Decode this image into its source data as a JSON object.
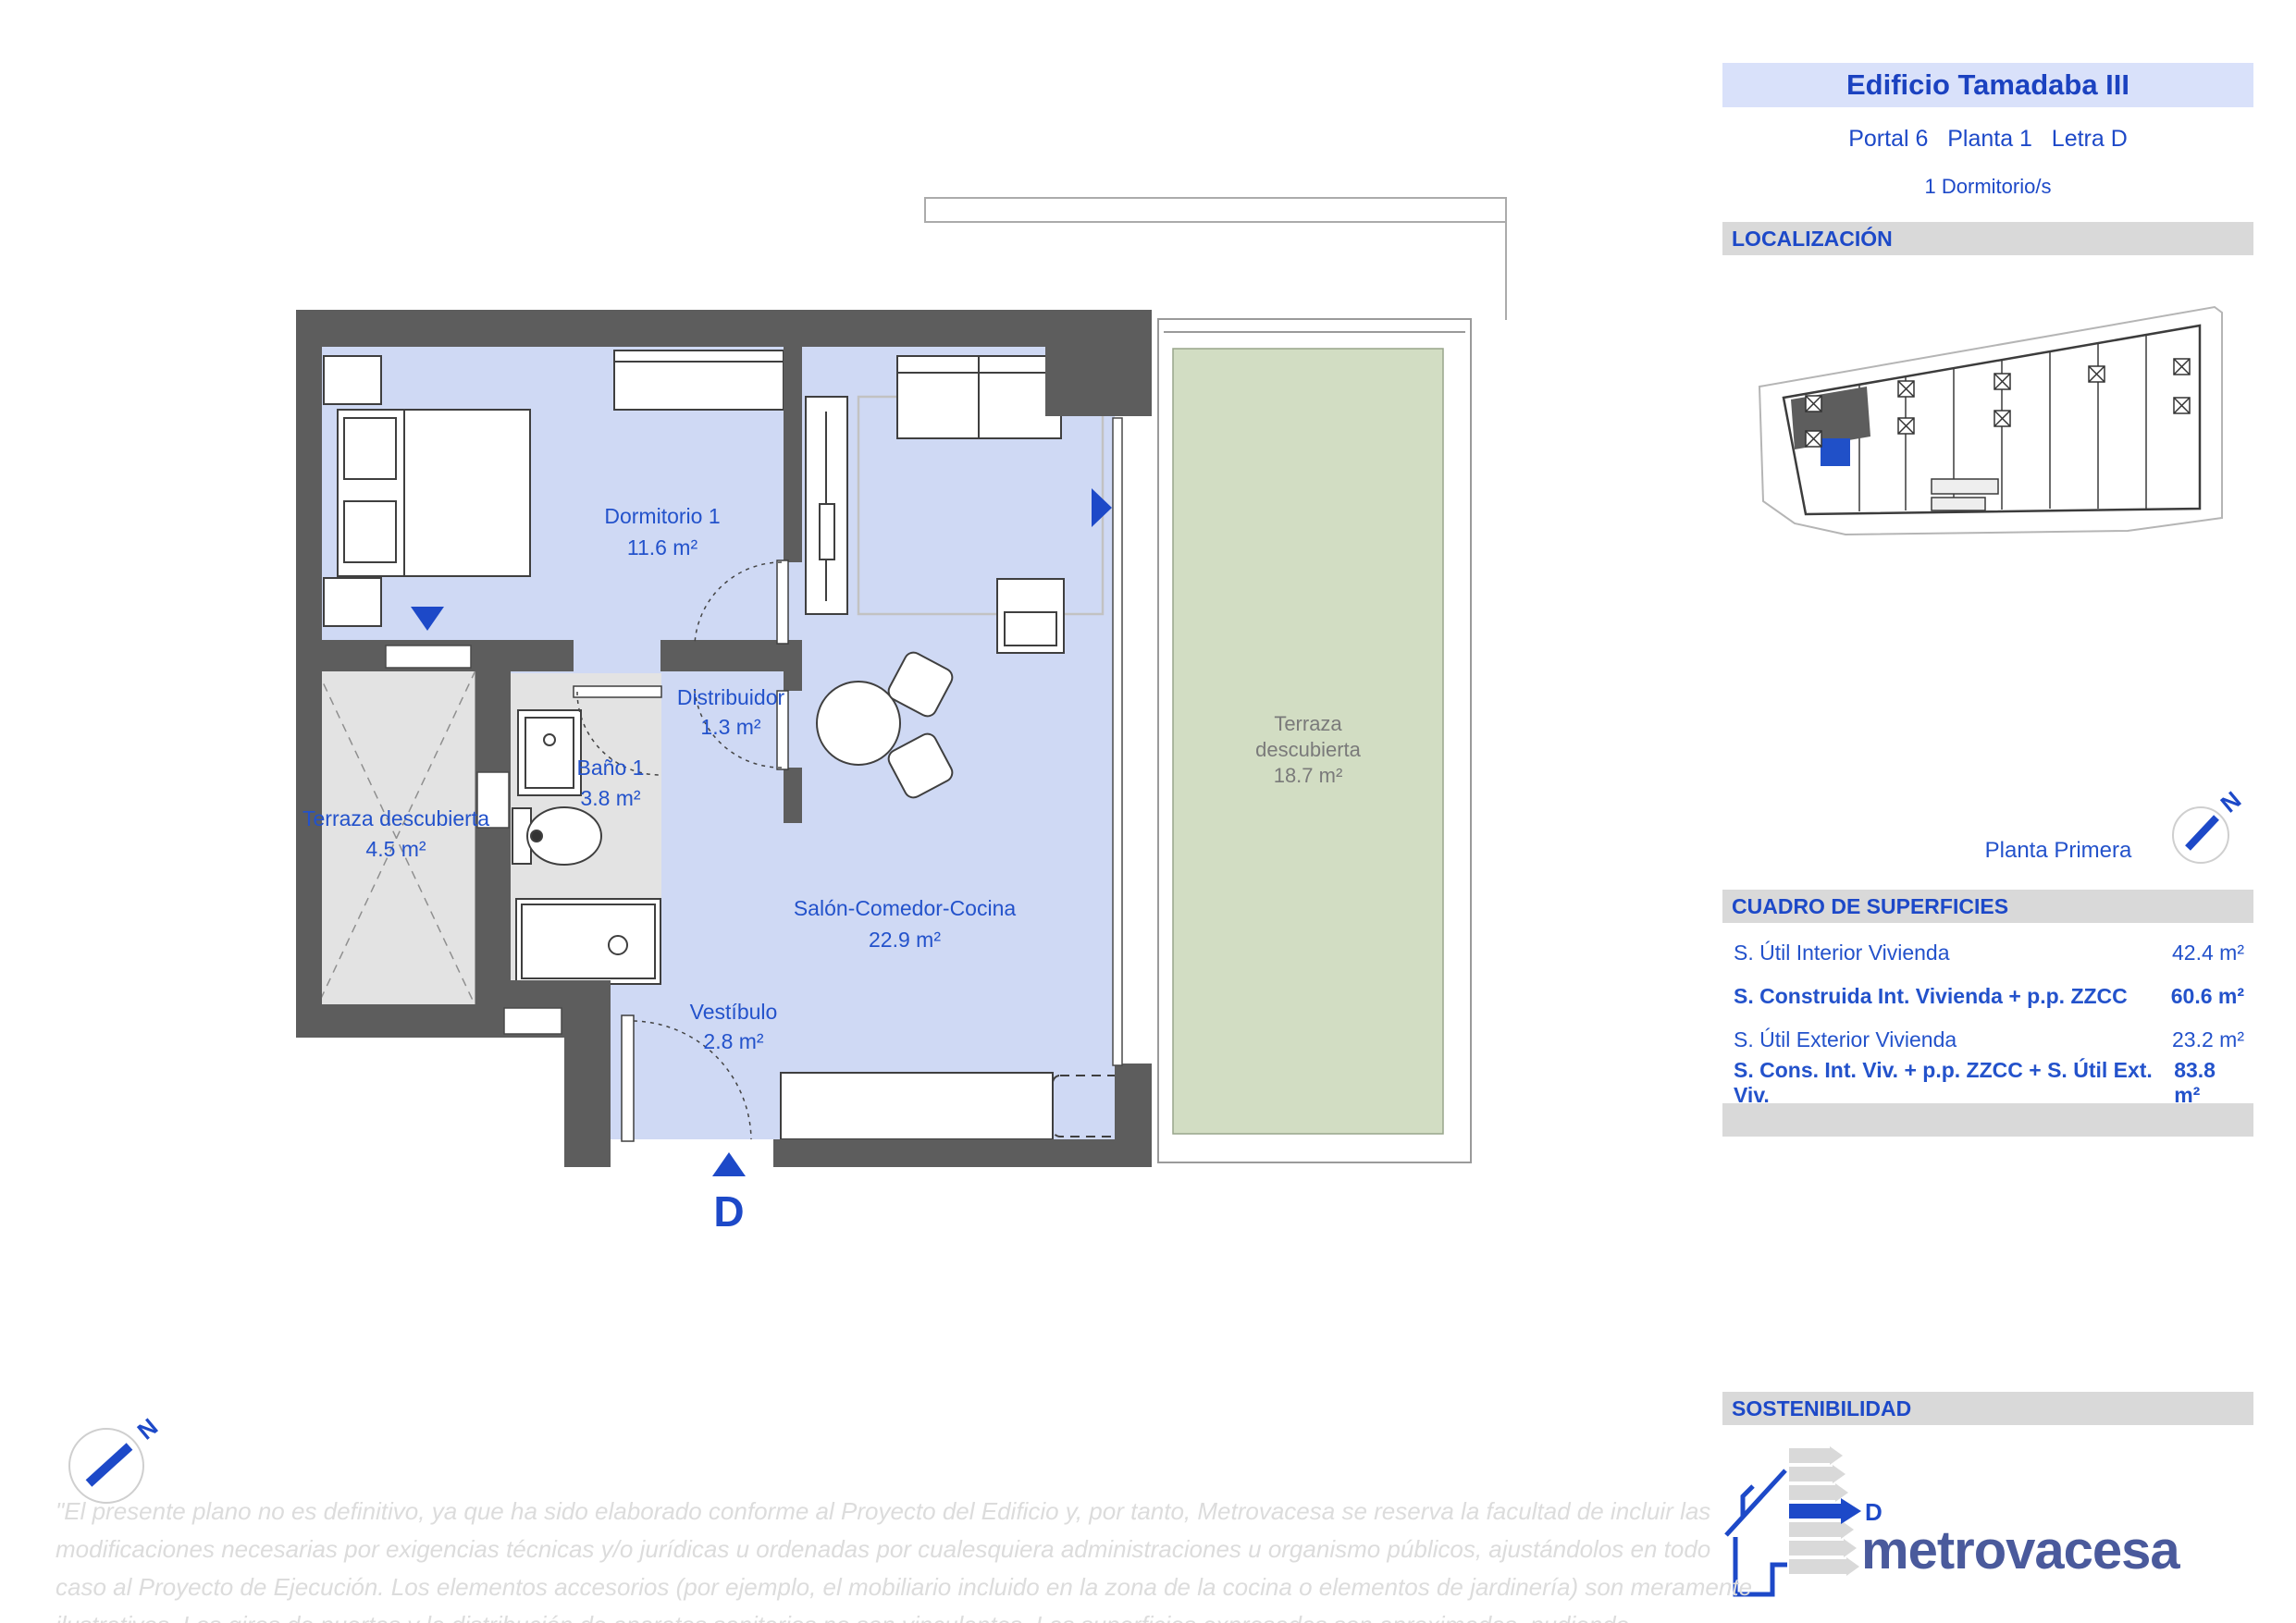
{
  "header": {
    "building": "Edificio Tamadaba III",
    "location_line": "Portal 6   Planta 1   Letra D",
    "bedrooms": "1 Dormitorio/s"
  },
  "section_titles": {
    "localizacion": "LOCALIZACIÓN",
    "superficies": "CUADRO DE SUPERFICIES",
    "sostenibilidad": "SOSTENIBILIDAD"
  },
  "panel": {
    "floor_name": "Planta Primera",
    "compass_letter": "N"
  },
  "surfaces": [
    {
      "label": "S. Útil Interior Vivienda",
      "value": "42.4 m²"
    },
    {
      "label": "S. Construida Int. Vivienda + p.p. ZZCC",
      "value": "60.6 m²"
    },
    {
      "label": "S. Útil Exterior Vivienda",
      "value": "23.2 m²"
    },
    {
      "label": "S. Cons. Int. Viv. + p.p. ZZCC + S. Útil Ext. Viv.",
      "value": "83.8 m²"
    }
  ],
  "plan": {
    "entrance_letter": "D",
    "rooms": {
      "dormitorio": {
        "name": "Dormitorio 1",
        "area": "11.6 m²"
      },
      "distribuidor": {
        "name": "Distribuidor",
        "area": "1.3 m²"
      },
      "bano": {
        "name": "Baño 1",
        "area": "3.8 m²"
      },
      "terraza_int": {
        "name": "Terraza descubierta",
        "area": "4.5 m²"
      },
      "salon": {
        "name": "Salón-Comedor-Cocina",
        "area": "22.9 m²"
      },
      "vestibulo": {
        "name": "Vestíbulo",
        "area": "2.8 m²"
      },
      "terraza_ext": {
        "line1": "Terraza",
        "line2": "descubierta",
        "area": "18.7 m²"
      }
    }
  },
  "energy": {
    "rating": "D"
  },
  "brand": "metrovacesa",
  "colors": {
    "accent_blue": "#1d49c8",
    "label_blue": "#2352cb",
    "title_bg": "#d9e1fa",
    "bar_gray": "#d9d9d9",
    "wall_gray": "#5d5d5d",
    "floor_blue": "#cfd9f4",
    "terrace_green": "#d2ddc3",
    "paving_gray": "#e3e3e3",
    "logo_blue": "#4a5a9c"
  },
  "disclaimer": "\"El presente plano no es definitivo, ya que ha sido elaborado conforme al Proyecto del Edificio y, por tanto, Metrovacesa se reserva la facultad de incluir las modificaciones necesarias por exigencias técnicas y/o jurídicas u ordenadas por cualesquiera administraciones u organismo públicos, ajustándolos en todo caso al Proyecto de Ejecución. Los elementos accesorios (por ejemplo, el mobiliario incluido en la zona de la cocina o elementos de jardinería) son meramente ilustrativos. Los giros de puertas y la distribución de aparatos sanitarios no son vinculantes. Las superficies expresadas son aproximadas, pudiendo experimentar modificaciones por razones de índole técnico y/o legal en el desarrollo de la ejecución de las obras\"."
}
